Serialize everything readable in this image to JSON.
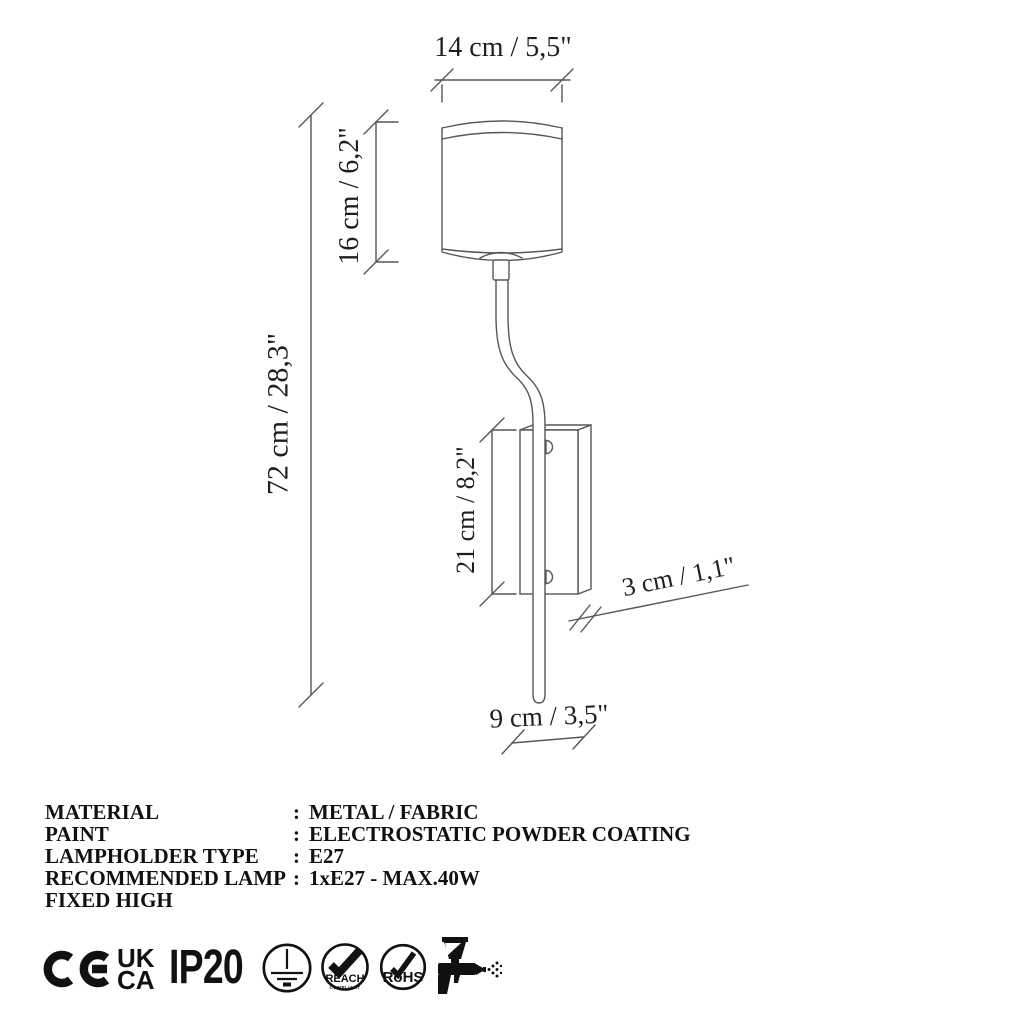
{
  "dimensions": {
    "shade_width": "14 cm / 5,5\"",
    "shade_height": "16 cm / 6,2\"",
    "total_height": "72 cm / 28,3\"",
    "bracket_height": "21 cm / 8,2\"",
    "bracket_depth": "3 cm / 1,1\"",
    "bottom_width": "9 cm / 3,5\""
  },
  "specs": {
    "rows": [
      {
        "label": "MATERIAL",
        "colon": ":",
        "value": "METAL / FABRIC"
      },
      {
        "label": "PAINT",
        "colon": ":",
        "value": "ELECTROSTATIC POWDER COATING"
      },
      {
        "label": "LAMPHOLDER TYPE",
        "colon": ":",
        "value": "E27"
      },
      {
        "label": "RECOMMENDED LAMP",
        "colon": ":",
        "value": "1xE27 - MAX.40W"
      },
      {
        "label": "FIXED HIGH",
        "colon": "",
        "value": ""
      }
    ]
  },
  "certifications": {
    "ukca_top": "UK",
    "ukca_bottom": "CA",
    "ip_rating": "IP20",
    "reach_label": "REACH",
    "reach_sub": "COMPLIANT",
    "rohs_label": "RoHS"
  },
  "colors": {
    "line": "#565656",
    "text": "#1f1f1f",
    "icon": "#111111"
  }
}
